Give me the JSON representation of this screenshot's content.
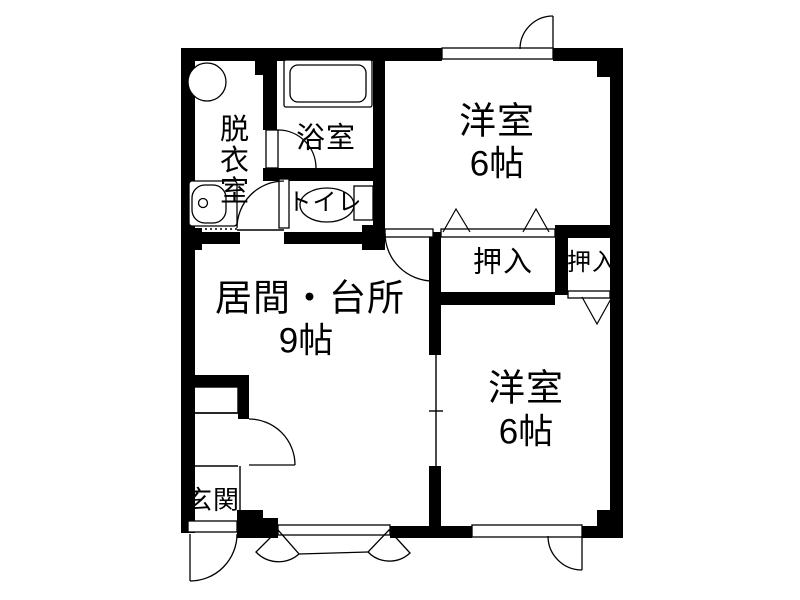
{
  "title": "1LDK間取り図",
  "colors": {
    "wall": "#000000",
    "background": "#ffffff",
    "line": "#000000"
  },
  "rooms": {
    "dressing": {
      "label": "脱衣室"
    },
    "bath": {
      "label": "浴室"
    },
    "toilet": {
      "label": "トイレ"
    },
    "western_top": {
      "label": "洋室",
      "size": "6帖"
    },
    "closet_large": {
      "label": "押入"
    },
    "closet_small": {
      "label": "押入"
    },
    "living_kitchen": {
      "label": "居間・台所",
      "size": "9帖"
    },
    "western_bottom": {
      "label": "洋室",
      "size": "6帖"
    },
    "entrance": {
      "label": "玄関"
    }
  }
}
